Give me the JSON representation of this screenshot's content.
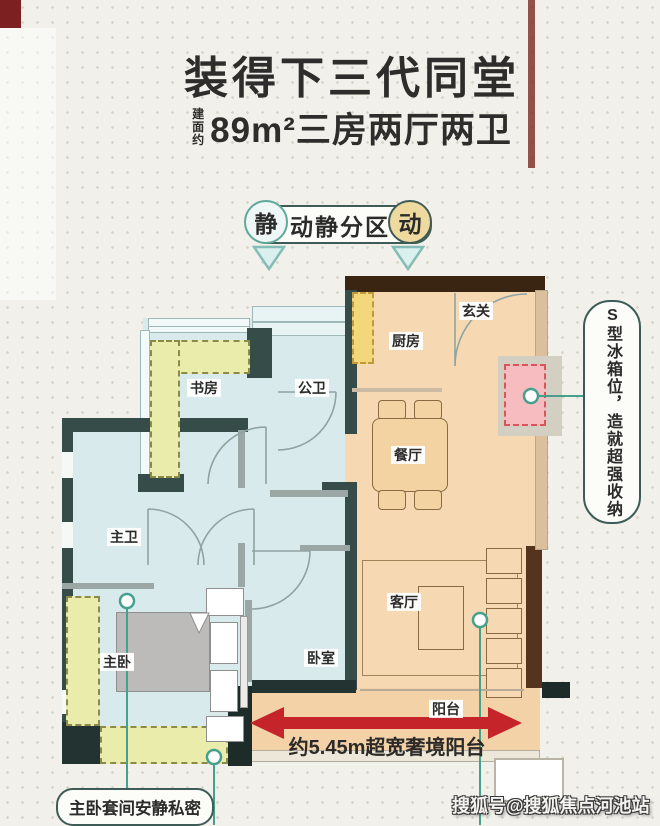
{
  "title": {
    "main": "装得下三代同堂",
    "area_prefix": "建面约",
    "area_line": "89m²三房两厅两卫"
  },
  "zoning": {
    "label": "动静分区",
    "quiet_badge": "静",
    "active_badge": "动"
  },
  "rooms": {
    "study": "书房",
    "public_bath": "公卫",
    "master_bath": "主卫",
    "master_bedroom": "主卧",
    "bedroom": "卧室",
    "entry": "玄关",
    "kitchen": "厨房",
    "dining": "餐厅",
    "living": "客厅",
    "balcony": "阳台"
  },
  "callouts": {
    "fridge": "S型冰箱位，造就超强收纳",
    "balcony_width": "约5.45m超宽奢境阳台",
    "master_suite": "主卧套间安静私密"
  },
  "watermark": "搜狐号@搜狐焦点河池站",
  "colors": {
    "quiet_floor": "#d9eaec",
    "active_floor": "#f6d8b2",
    "balcony_floor": "#f3d2a8",
    "wall_slate": "#354c49",
    "wall_brown": "#3a2513",
    "accent_teal": "#45a08e",
    "arrow_red": "#c5242b",
    "storage_yellow": "#e9ecab",
    "fridge_pink": "#f7bcc0"
  }
}
